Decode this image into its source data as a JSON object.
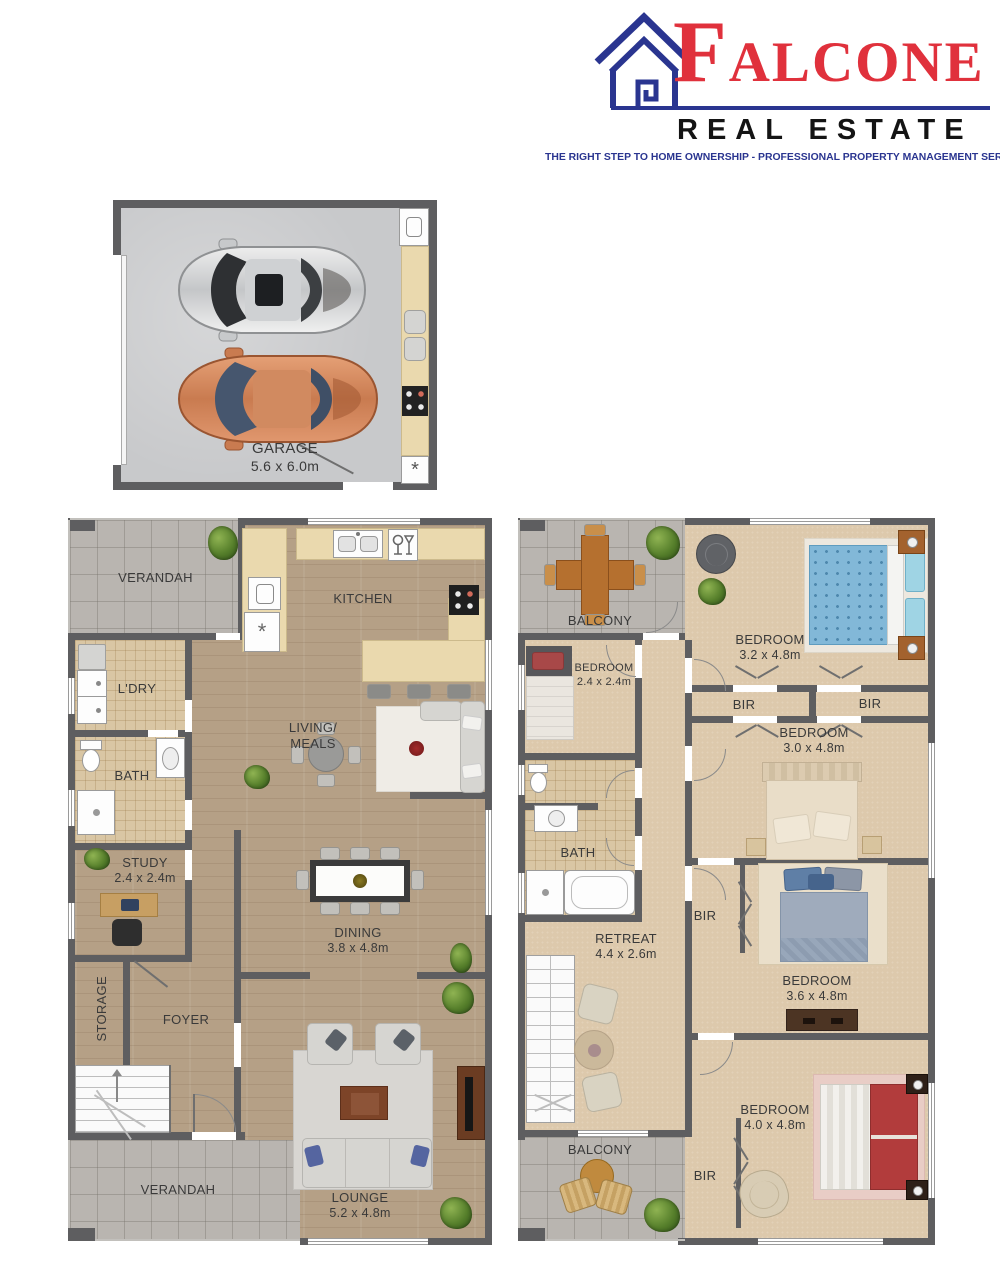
{
  "brand": {
    "name": "FALCONE",
    "name_first_letter": "F",
    "name_rest": "ALCONE",
    "division": "REAL ESTATE",
    "tagline": "THE RIGHT STEP TO HOME OWNERSHIP -  PROFESSIONAL PROPERTY MANAGEMENT SERVICES",
    "colors": {
      "red": "#e0313c",
      "navy": "#2a3590",
      "text": "#141414"
    }
  },
  "floorplans": {
    "garage": {
      "title": "GARAGE",
      "dims": "5.6 x 6.0m",
      "hot_water_symbol": "*"
    },
    "ground": {
      "verandah_top": "VERANDAH",
      "kitchen": "KITCHEN",
      "laundry": "L'DRY",
      "bath": "BATH",
      "living_line1": "LIVING/",
      "living_line2": "MEALS",
      "study": "STUDY",
      "study_dims": "2.4 x 2.4m",
      "storage": "STORAGE",
      "foyer": "FOYER",
      "dining": "DINING",
      "dining_dims": "3.8 x 4.8m",
      "lounge": "LOUNGE",
      "lounge_dims": "5.2 x 4.8m",
      "verandah_bottom": "VERANDAH",
      "fridge_symbol": "*"
    },
    "upper": {
      "balcony_top": "BALCONY",
      "bedroom_small": "BEDROOM",
      "bedroom_small_dims": "2.4 x 2.4m",
      "bedroom_32": "BEDROOM",
      "bedroom_32_dims": "3.2 x 4.8m",
      "bir_left": "BIR",
      "bir_right": "BIR",
      "bedroom_30": "BEDROOM",
      "bedroom_30_dims": "3.0 x 4.8m",
      "bath": "BATH",
      "retreat": "RETREAT",
      "retreat_dims": "4.4 x 2.6m",
      "bir_mid": "BIR",
      "bedroom_36": "BEDROOM",
      "bedroom_36_dims": "3.6 x 4.8m",
      "bedroom_40": "BEDROOM",
      "bedroom_40_dims": "4.0 x 4.8m",
      "bir_bottom": "BIR",
      "balcony_bottom": "BALCONY"
    }
  }
}
